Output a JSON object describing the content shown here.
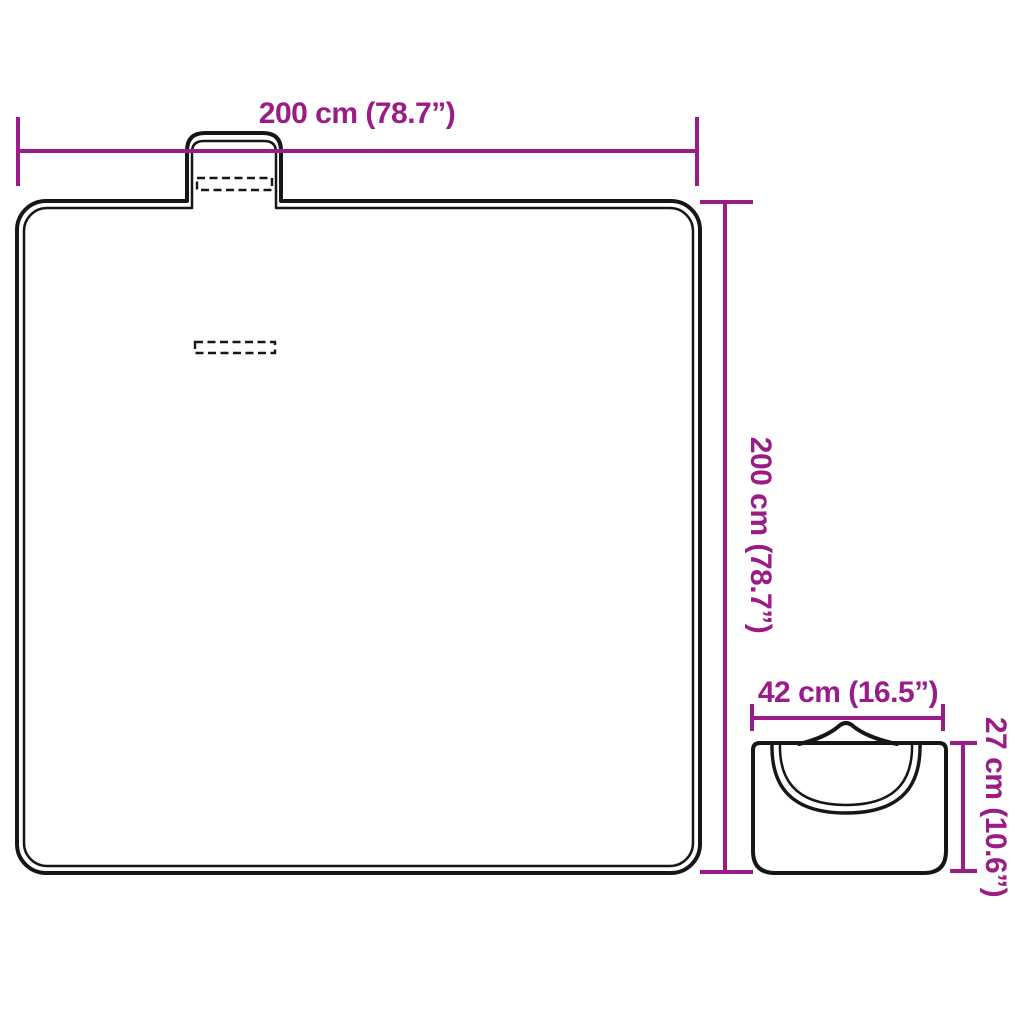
{
  "colors": {
    "dimension": "#991c87",
    "outline": "#161616",
    "background": "#ffffff"
  },
  "diagram": {
    "name": "folding-picnic-blanket-dimensions",
    "unfolded": {
      "width_label": "200 cm (78.7”)",
      "height_label": "200 cm (78.7”)"
    },
    "folded": {
      "width_label": "42 cm (16.5”)",
      "height_label": "27 cm (10.6”)"
    }
  }
}
